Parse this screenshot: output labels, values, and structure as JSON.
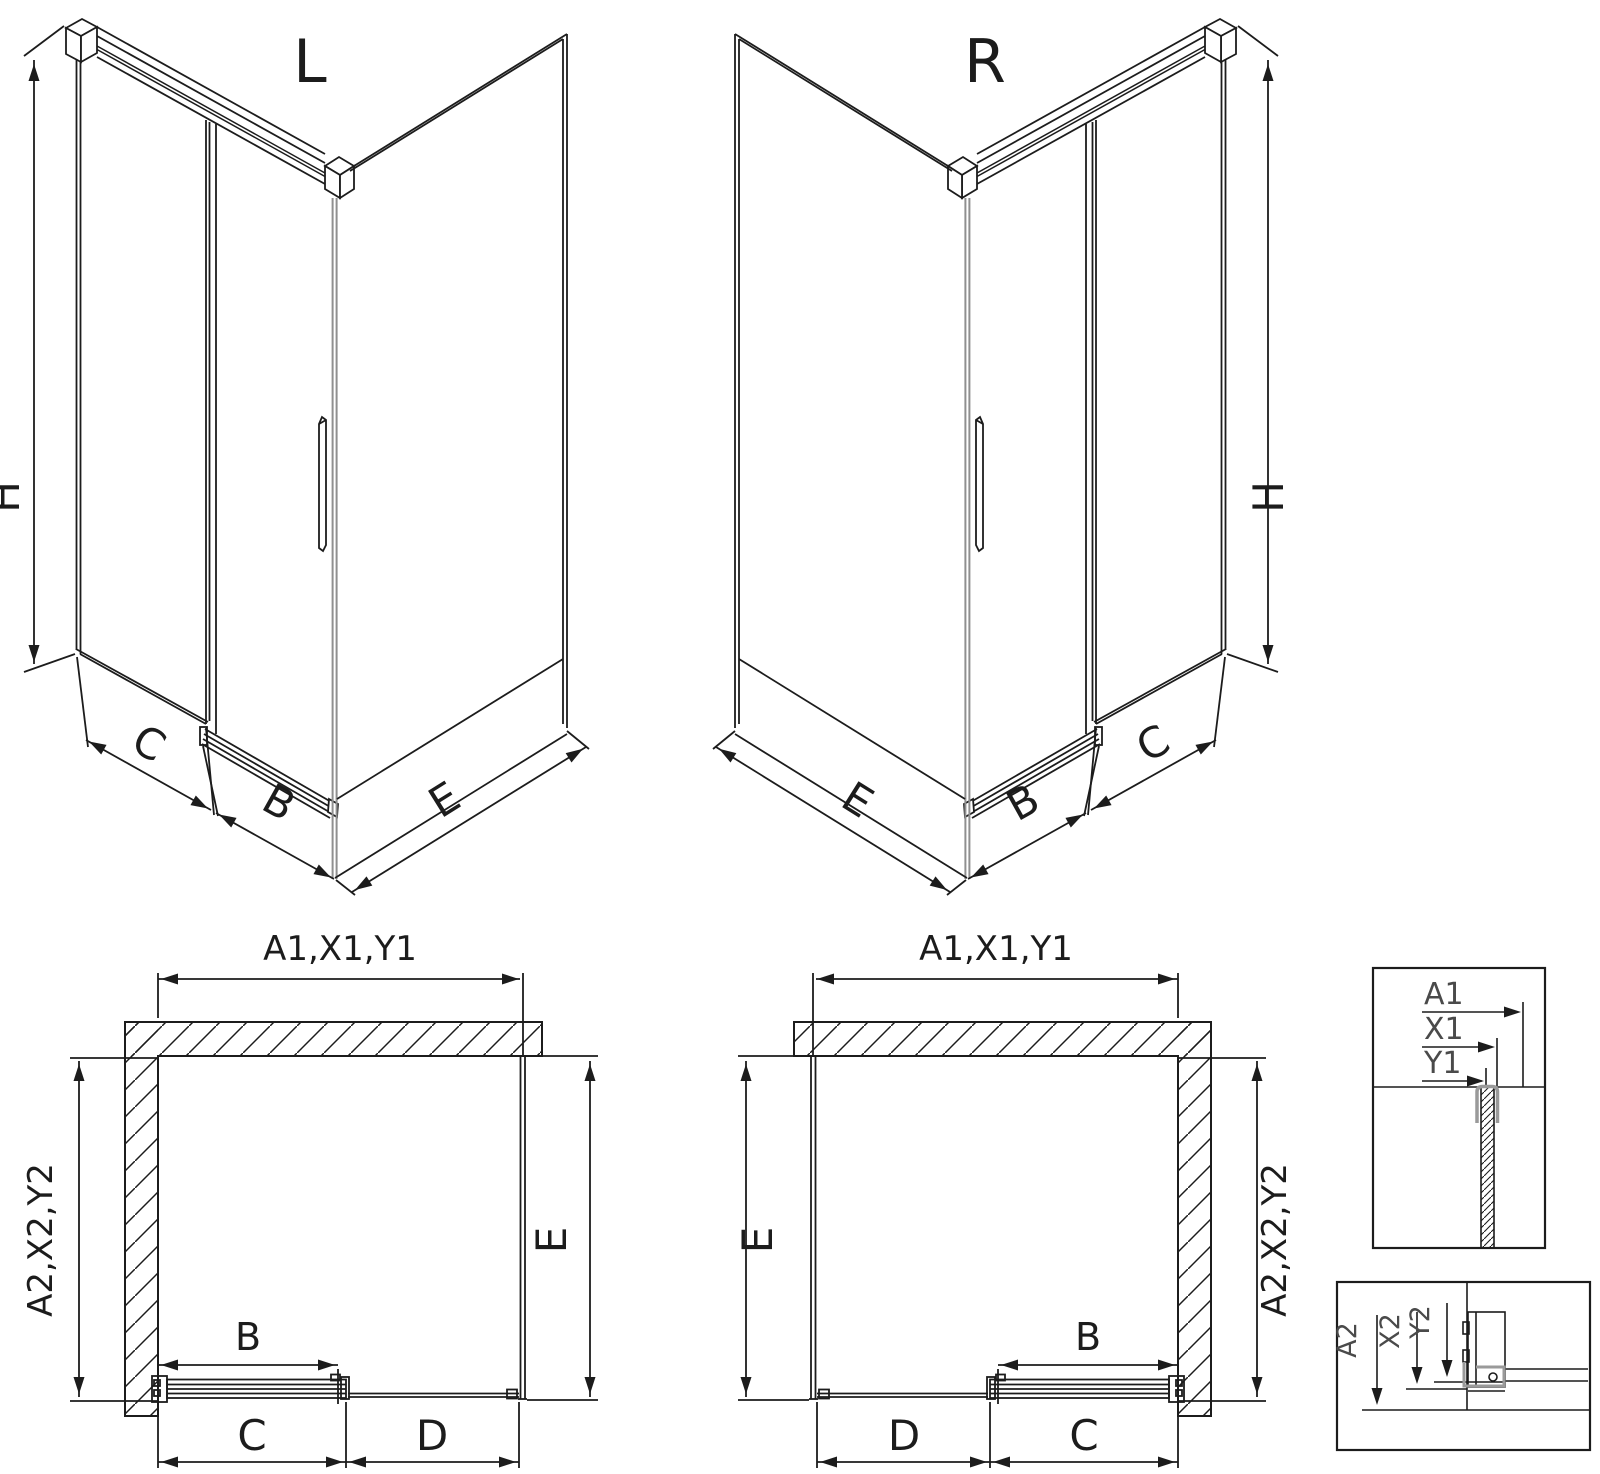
{
  "drawing": {
    "background": "#ffffff",
    "line_color": "#1c1c1c",
    "accent_gray": "#8f8f8f",
    "clamp_gray": "#9a9a9a",
    "detail_label_color": "#4a4a4a",
    "iso_left": {
      "title": "L",
      "height": "H",
      "side": "C",
      "door": "B",
      "return_side": "E"
    },
    "iso_right": {
      "title": "R",
      "height": "H",
      "side": "C",
      "door": "B",
      "return_side": "E"
    },
    "plan_left": {
      "width_top": "A1,X1,Y1",
      "depth_wall": "A2,X2,Y2",
      "depth_open": "E",
      "door": "B",
      "bottom_near_wall": "C",
      "bottom_far": "D"
    },
    "plan_right": {
      "width_top": "A1,X1,Y1",
      "depth_wall": "A2,X2,Y2",
      "depth_open": "E",
      "door": "B",
      "bottom_near_wall": "C",
      "bottom_far": "D"
    },
    "detail_top": {
      "label_a": "A1",
      "label_x": "X1",
      "label_y": "Y1"
    },
    "detail_bottom": {
      "label_a": "A2",
      "label_x": "X2",
      "label_y": "Y2"
    }
  }
}
